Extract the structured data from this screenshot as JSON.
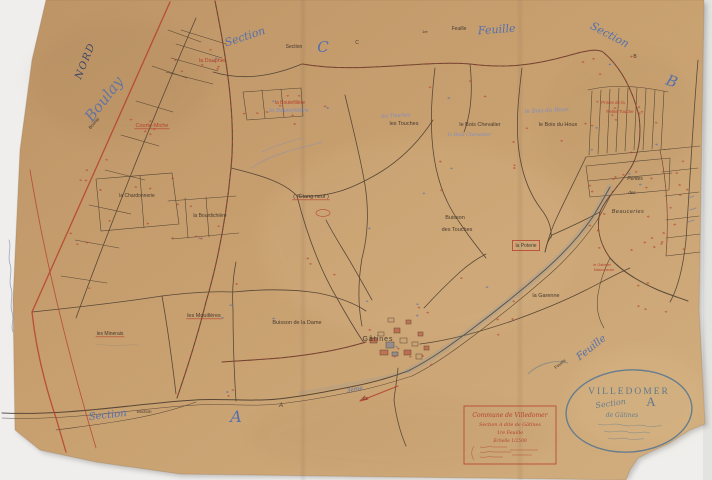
{
  "map": {
    "colors": {
      "paper": "#c7a171",
      "background": "#efeeec",
      "black": "#46392e",
      "red": "#b5412e",
      "blue": "#5570ab",
      "blue_faint": "#7b8cc2",
      "dark_blue": "#3d4666",
      "stamp": "#557590"
    },
    "labels": [
      {
        "id": "nord",
        "t": "NORD",
        "x": 88,
        "y": 62,
        "s": 10,
        "c": "dark_blue",
        "r": -68,
        "sc": true,
        "ls": 1.5
      },
      {
        "id": "boulay-script",
        "t": "Boulay",
        "x": 108,
        "y": 102,
        "s": 15,
        "c": "blue",
        "r": -52,
        "sc": true,
        "o": 0.85
      },
      {
        "id": "boulay-small",
        "t": "Boulay",
        "x": 95,
        "y": 124,
        "s": 4.5,
        "c": "black",
        "r": -50
      },
      {
        "id": "section-c-script",
        "t": "Section",
        "x": 246,
        "y": 40,
        "s": 11,
        "c": "blue",
        "r": -18,
        "sc": true
      },
      {
        "id": "section-c-print",
        "t": "Section",
        "x": 294,
        "y": 48,
        "s": 5,
        "c": "black"
      },
      {
        "id": "letter-c-large",
        "t": "C",
        "x": 323,
        "y": 52,
        "s": 15,
        "c": "blue",
        "sc": true
      },
      {
        "id": "letter-c-small",
        "t": "C",
        "x": 357,
        "y": 44,
        "s": 5,
        "c": "black"
      },
      {
        "id": "num-1er",
        "t": "1er",
        "x": 425,
        "y": 33,
        "s": 4,
        "c": "black"
      },
      {
        "id": "feuille-print-top",
        "t": "Feuille",
        "x": 459,
        "y": 30,
        "s": 5,
        "c": "black"
      },
      {
        "id": "feuille-script-top",
        "t": "Feuille",
        "x": 497,
        "y": 33,
        "s": 11,
        "c": "blue",
        "r": -4,
        "sc": true
      },
      {
        "id": "section-b-script",
        "t": "Section",
        "x": 608,
        "y": 38,
        "s": 11,
        "c": "blue",
        "r": 28,
        "sc": true
      },
      {
        "id": "letter-b-small",
        "t": "B",
        "x": 635,
        "y": 58,
        "s": 5,
        "c": "black"
      },
      {
        "id": "letter-b-large",
        "t": "B",
        "x": 670,
        "y": 86,
        "s": 15,
        "c": "blue",
        "r": 20,
        "sc": true
      },
      {
        "id": "la-dauphie",
        "t": "la Dauphie",
        "x": 212,
        "y": 62,
        "s": 5.5,
        "c": "red"
      },
      {
        "id": "courte-miche",
        "t": "Courte-Miche",
        "x": 152,
        "y": 127,
        "s": 5.5,
        "c": "red",
        "u": true
      },
      {
        "id": "la-boutefiliere",
        "t": "la Boutefilière",
        "x": 290,
        "y": 104,
        "s": 5,
        "c": "red"
      },
      {
        "id": "la-boutefiliere-script",
        "t": "la Boutefilière",
        "x": 289,
        "y": 112,
        "s": 5.5,
        "c": "blue_faint",
        "sc": true
      },
      {
        "id": "les-touches-script",
        "t": "les Touches",
        "x": 396,
        "y": 117,
        "s": 5,
        "c": "blue_faint",
        "sc": true,
        "r": -3
      },
      {
        "id": "les-touches",
        "t": "les Touches",
        "x": 404,
        "y": 125,
        "s": 5.5,
        "c": "black"
      },
      {
        "id": "le-bois-chevalier",
        "t": "le Bois Chevalier",
        "x": 480,
        "y": 126,
        "s": 5.5,
        "c": "black"
      },
      {
        "id": "le-bois-chevalier-script",
        "t": "le Bois Chevalier",
        "x": 469,
        "y": 136,
        "s": 5,
        "c": "blue_faint",
        "sc": true
      },
      {
        "id": "le-bois-du-houx-script",
        "t": "le Bois du Houx",
        "x": 547,
        "y": 112,
        "s": 5.5,
        "c": "blue_faint",
        "sc": true,
        "r": -3
      },
      {
        "id": "le-bois-du-houx",
        "t": "le Bois du Houx",
        "x": 558,
        "y": 126,
        "s": 5.5,
        "c": "black"
      },
      {
        "id": "prises-1",
        "t": "Prises de la",
        "x": 613,
        "y": 104,
        "s": 4.5,
        "c": "red"
      },
      {
        "id": "prises-2",
        "t": "Petite Touche",
        "x": 620,
        "y": 113,
        "s": 4.5,
        "c": "red"
      },
      {
        "id": "la-chardonnerie",
        "t": "la Chardonnerie",
        "x": 137,
        "y": 197,
        "s": 5,
        "c": "black"
      },
      {
        "id": "la-bourdichiere",
        "t": "la Bourdichière",
        "x": 210,
        "y": 217,
        "s": 5,
        "c": "black"
      },
      {
        "id": "etang-neuf",
        "t": "( l'Étang neuf )",
        "x": 311,
        "y": 198,
        "s": 5.5,
        "c": "black",
        "u": true
      },
      {
        "id": "pentes",
        "t": "Pentes",
        "x": 635,
        "y": 180,
        "s": 5,
        "c": "black",
        "it": true
      },
      {
        "id": "pentes-des",
        "t": "des",
        "x": 632,
        "y": 194,
        "s": 4.5,
        "c": "black",
        "it": true
      },
      {
        "id": "beauceries",
        "t": "Beauceries",
        "x": 628,
        "y": 213,
        "s": 5.5,
        "c": "black",
        "it": true,
        "ls": 0.5
      },
      {
        "id": "buisson-touches-1",
        "t": "Buisson",
        "x": 455,
        "y": 219,
        "s": 5.5,
        "c": "black"
      },
      {
        "id": "buisson-touches-2",
        "t": "des Touches",
        "x": 457,
        "y": 231,
        "s": 5.5,
        "c": "black"
      },
      {
        "id": "la-poterie",
        "t": "la Poterie",
        "x": 526,
        "y": 247,
        "s": 5,
        "c": "black",
        "bx": true
      },
      {
        "id": "le-gabelet-1",
        "t": "le Gabelet",
        "x": 602,
        "y": 266,
        "s": 3.8,
        "c": "red"
      },
      {
        "id": "le-gabelet-2",
        "t": "Maisonneuve",
        "x": 604,
        "y": 271,
        "s": 3.4,
        "c": "red"
      },
      {
        "id": "la-garenne",
        "t": "la Garenne",
        "x": 546,
        "y": 297,
        "s": 5.5,
        "c": "black"
      },
      {
        "id": "buisson-de-la-dame",
        "t": "Buisson de la Dame",
        "x": 297,
        "y": 324,
        "s": 5.5,
        "c": "black"
      },
      {
        "id": "les-mouilleres",
        "t": "les Mouillères",
        "x": 204,
        "y": 317,
        "s": 5.5,
        "c": "black",
        "u": true
      },
      {
        "id": "les-minerais",
        "t": "les Minerais",
        "x": 110,
        "y": 335,
        "s": 5,
        "c": "black",
        "u": true
      },
      {
        "id": "gatines",
        "t": "Gâtines",
        "x": 378,
        "y": 341,
        "s": 7,
        "c": "black",
        "ls": 1
      },
      {
        "id": "section-bottom-script",
        "t": "Section",
        "x": 108,
        "y": 418,
        "s": 10,
        "c": "blue",
        "r": -6,
        "sc": true
      },
      {
        "id": "section-bottom-print",
        "t": "Section",
        "x": 144,
        "y": 413,
        "s": 4.5,
        "c": "black"
      },
      {
        "id": "letter-a-large",
        "t": "A",
        "x": 236,
        "y": 422,
        "s": 16,
        "c": "blue",
        "sc": true
      },
      {
        "id": "letter-a-small",
        "t": "A",
        "x": 281,
        "y": 407,
        "s": 6,
        "c": "black",
        "it": true
      },
      {
        "id": "trois-eme",
        "t": "3ème",
        "x": 355,
        "y": 391,
        "s": 6,
        "c": "blue",
        "sc": true,
        "r": -10
      },
      {
        "id": "num-27",
        "t": "27",
        "x": 365,
        "y": 400,
        "s": 4.5,
        "c": "black"
      },
      {
        "id": "feuille-br-print",
        "t": "Feuille",
        "x": 561,
        "y": 365,
        "s": 4.5,
        "c": "black",
        "r": -38
      },
      {
        "id": "feuille-br-script",
        "t": "Feuille",
        "x": 593,
        "y": 350,
        "s": 10,
        "c": "blue",
        "r": -38,
        "sc": true
      }
    ]
  },
  "cartouche": {
    "line1": "Commune de Villedomer",
    "line2": "Section A dite de Gâtines",
    "line3": "1re Feuille",
    "line4": "Échelle 1/2500"
  },
  "stamp": {
    "title": "VILLEDOMER",
    "script_word": "Section",
    "letter": "A",
    "line2": "de Gâtines"
  }
}
